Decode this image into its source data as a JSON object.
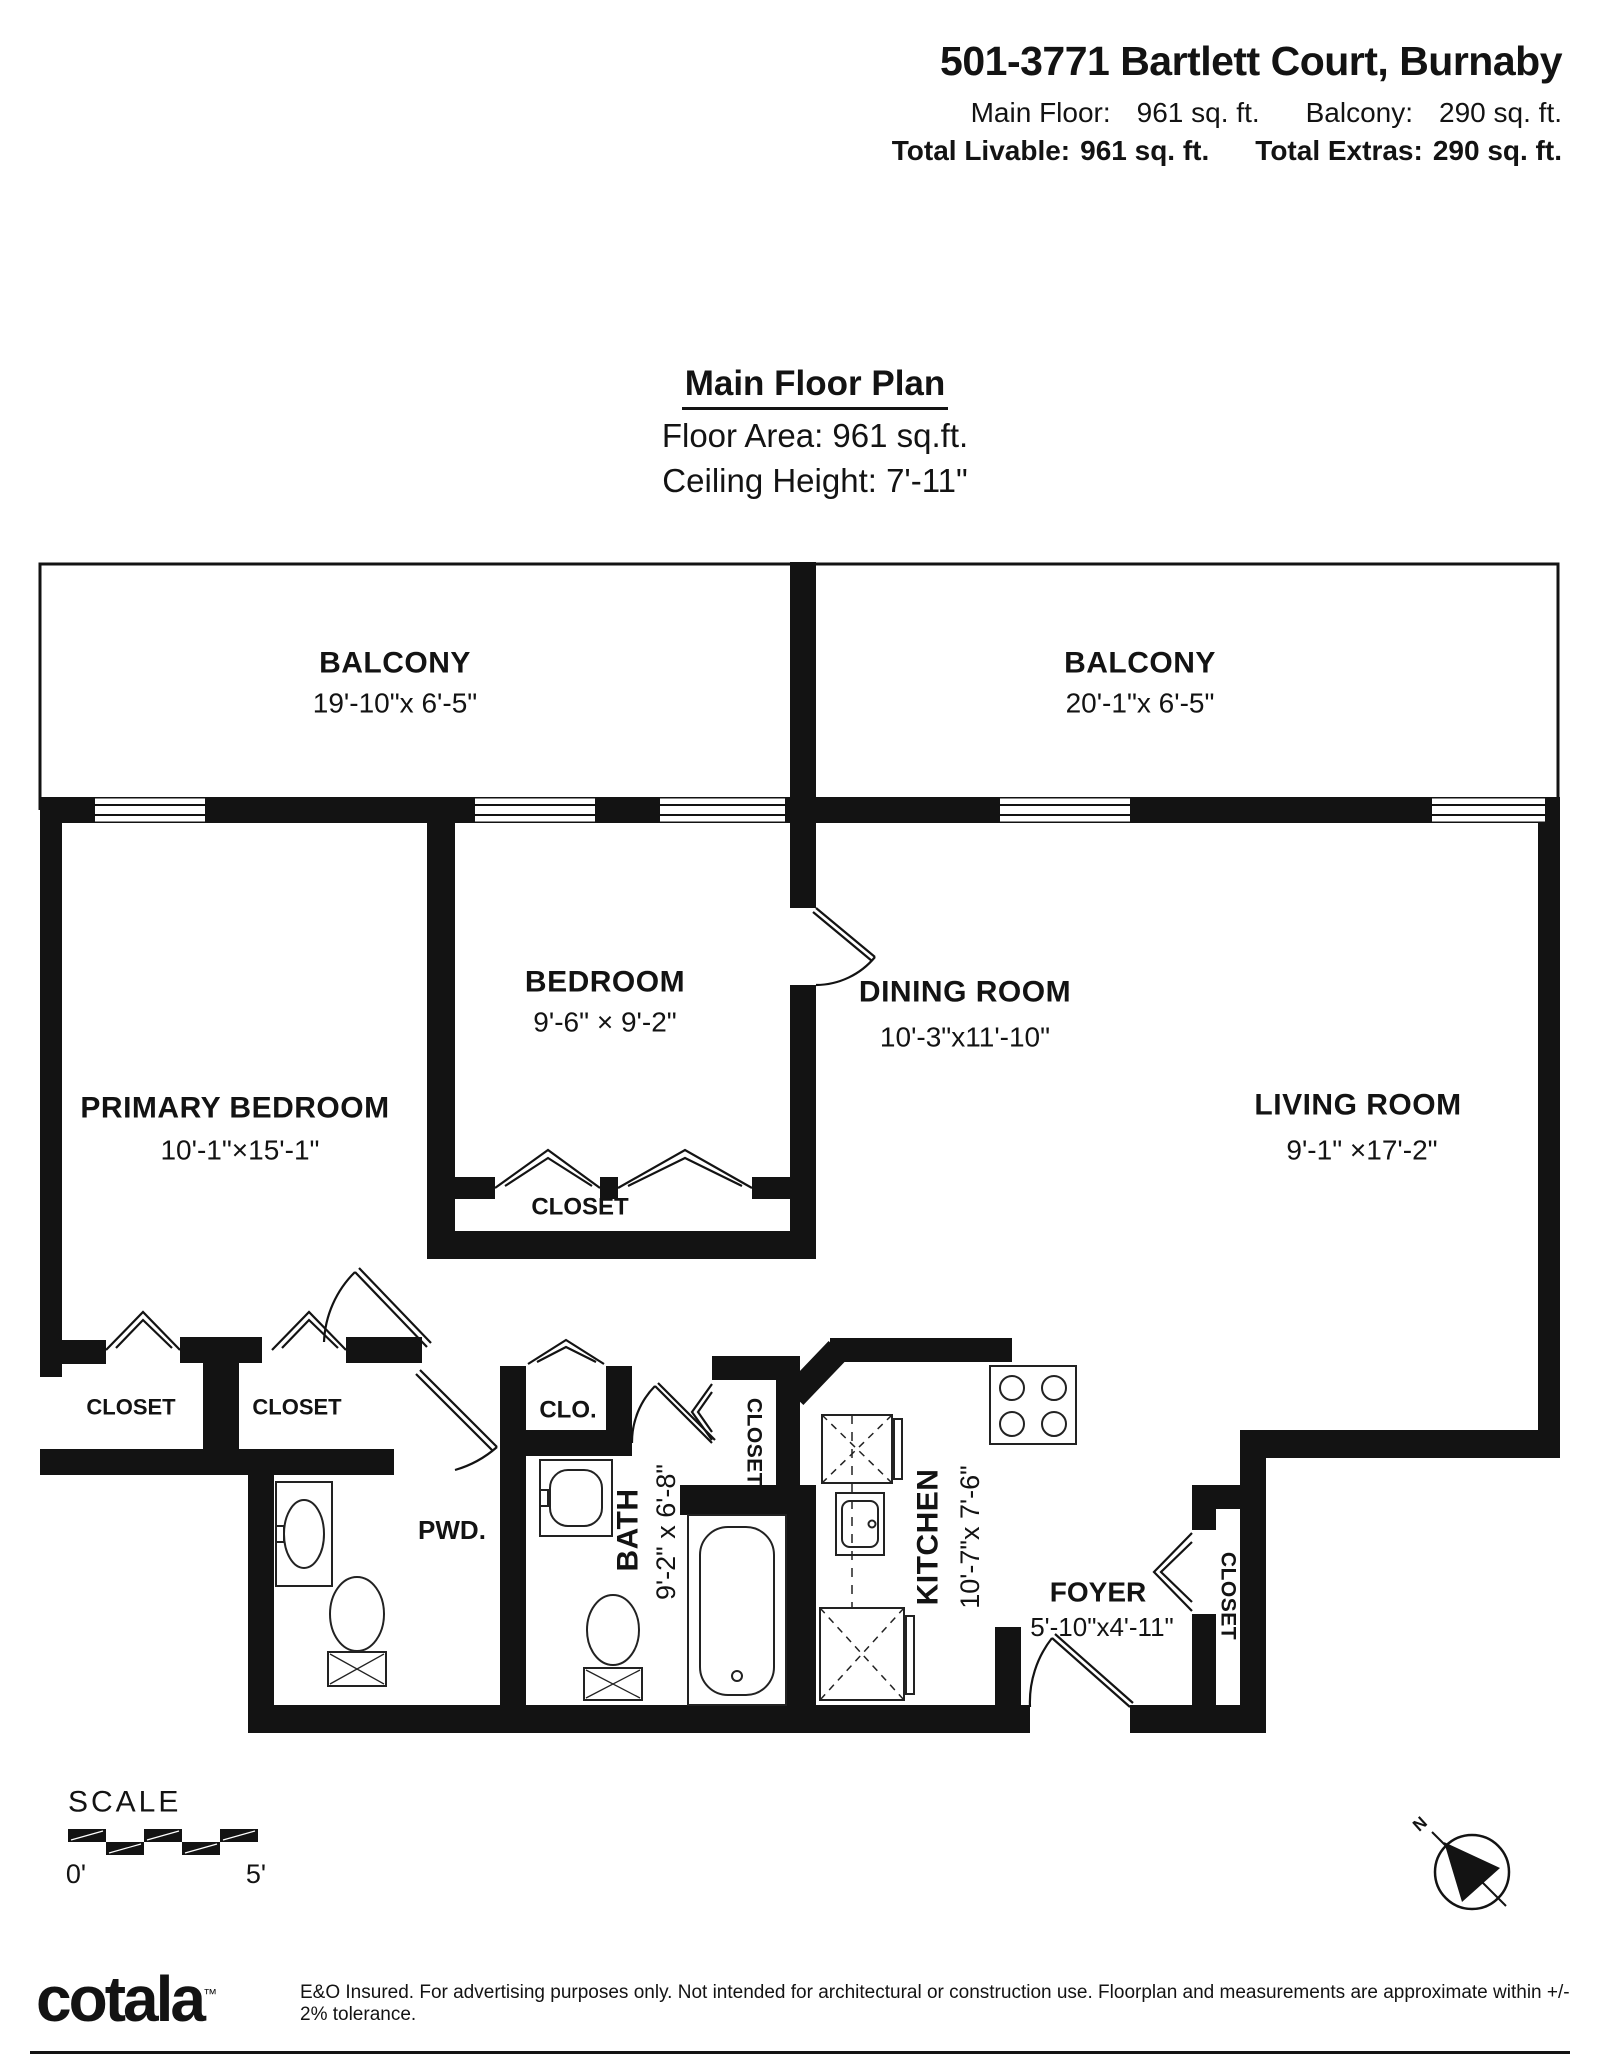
{
  "header": {
    "title": "501-3771 Bartlett Court, Burnaby",
    "main_floor_label": "Main Floor:",
    "main_floor_value": "961 sq. ft.",
    "balcony_label": "Balcony:",
    "balcony_value": "290 sq. ft.",
    "total_livable_label": "Total Livable:",
    "total_livable_value": "961 sq. ft.",
    "total_extras_label": "Total Extras:",
    "total_extras_value": "290 sq. ft."
  },
  "plan_header": {
    "title": "Main Floor Plan",
    "floor_area": "Floor Area: 961 sq.ft.",
    "ceiling_height": "Ceiling Height: 7'-11\""
  },
  "rooms": {
    "balcony_left": {
      "name": "BALCONY",
      "dims": "19'-10\"x 6'-5\""
    },
    "balcony_right": {
      "name": "BALCONY",
      "dims": "20'-1\"x 6'-5\""
    },
    "bedroom": {
      "name": "BEDROOM",
      "dims": "9'-6\" × 9'-2\""
    },
    "dining": {
      "name": "DINING ROOM",
      "dims": "10'-3\"x11'-10\""
    },
    "primary": {
      "name": "PRIMARY BEDROOM",
      "dims": "10'-1\"×15'-1\""
    },
    "living": {
      "name": "LIVING ROOM",
      "dims": "9'-1\" ×17'-2\""
    },
    "closet_bedroom": "CLOSET",
    "closet_left_1": "CLOSET",
    "closet_left_2": "CLOSET",
    "clo": "CLO.",
    "pwd": "PWD.",
    "bath": {
      "name": "BATH",
      "dims": "9'-2\" x 6'-8\""
    },
    "closet_hall": "CLOSET",
    "kitchen": {
      "name": "KITCHEN",
      "dims": "10'-7\"x 7'-6\""
    },
    "foyer": {
      "name": "FOYER",
      "dims": "5'-10\"x4'-11\""
    },
    "closet_foyer": "CLOSET"
  },
  "scale": {
    "label": "SCALE",
    "start": "0'",
    "end": "5'"
  },
  "compass": {
    "north_label": "N"
  },
  "footer": {
    "brand": "cotala",
    "tm": "™",
    "disclaimer": "E&O Insured. For advertising purposes only. Not intended for architectural or construction use. Floorplan and measurements are approximate within +/- 2% tolerance."
  },
  "colors": {
    "ink": "#131313",
    "paper": "#ffffff"
  }
}
